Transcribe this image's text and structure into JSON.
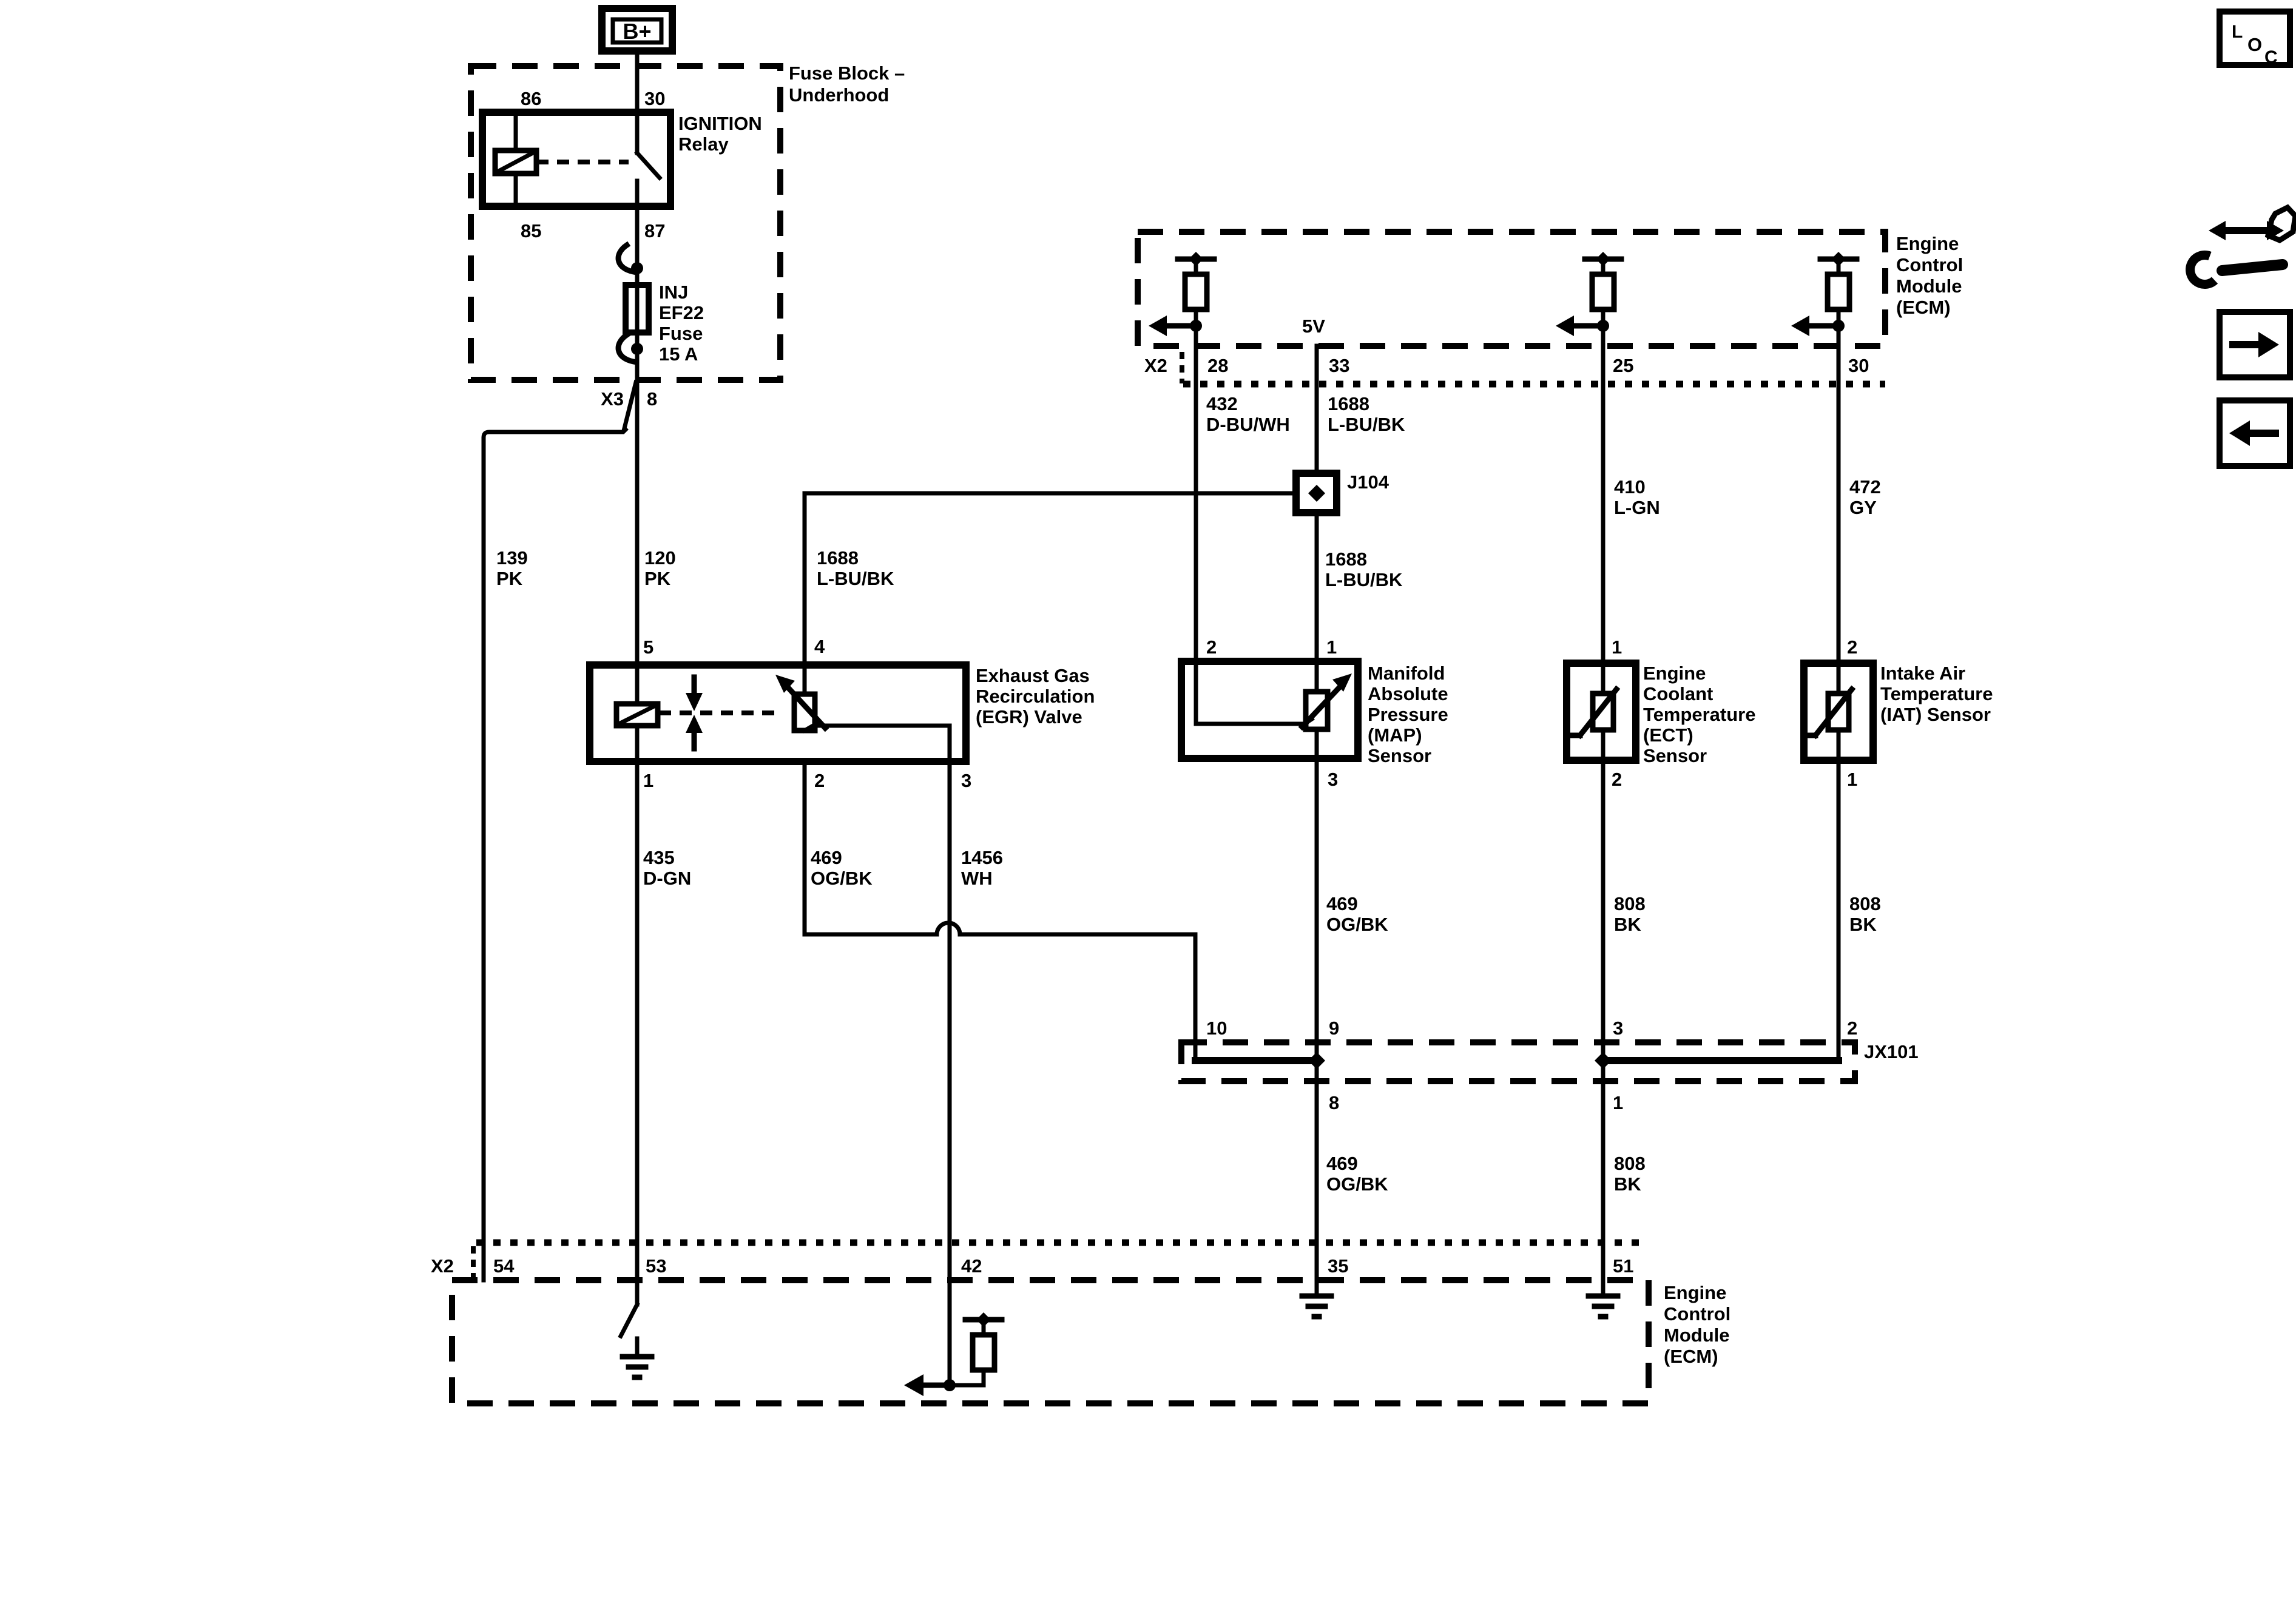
{
  "fuse_block": {
    "label_line1": "Fuse Block –",
    "label_line2": "Underhood",
    "battery": "B+",
    "relay": {
      "name_line1": "IGNITION",
      "name_line2": "Relay",
      "pin_86": "86",
      "pin_30": "30",
      "pin_85": "85",
      "pin_87": "87"
    },
    "fuse": {
      "line1": "INJ",
      "line2": "EF22",
      "line3": "Fuse",
      "line4": "15 A"
    },
    "connector": {
      "name": "X3",
      "pin": "8"
    }
  },
  "ecm_top": {
    "connector": "X2",
    "supply": "5V",
    "pin_28": "28",
    "pin_33": "33",
    "pin_25": "25",
    "pin_30": "30",
    "name_line1": "Engine",
    "name_line2": "Control",
    "name_line3": "Module",
    "name_line4": "(ECM)"
  },
  "ecm_bottom": {
    "connector": "X2",
    "pin_54": "54",
    "pin_53": "53",
    "pin_42": "42",
    "pin_35": "35",
    "pin_51": "51",
    "name_line1": "Engine",
    "name_line2": "Control",
    "name_line3": "Module",
    "name_line4": "(ECM)"
  },
  "egr_valve": {
    "name_line1": "Exhaust Gas",
    "name_line2": "Recirculation",
    "name_line3": "(EGR) Valve",
    "pin_5": "5",
    "pin_4": "4",
    "pin_1": "1",
    "pin_2": "2",
    "pin_3": "3"
  },
  "map_sensor": {
    "name_line1": "Manifold",
    "name_line2": "Absolute",
    "name_line3": "Pressure",
    "name_line4": "(MAP)",
    "name_line5": "Sensor",
    "pin_2": "2",
    "pin_1": "1",
    "pin_3": "3"
  },
  "ect_sensor": {
    "name_line1": "Engine",
    "name_line2": "Coolant",
    "name_line3": "Temperature",
    "name_line4": "(ECT)",
    "name_line5": "Sensor",
    "pin_1": "1",
    "pin_2": "2"
  },
  "iat_sensor": {
    "name_line1": "Intake Air",
    "name_line2": "Temperature",
    "name_line3": "(IAT) Sensor",
    "pin_2": "2",
    "pin_1": "1"
  },
  "junctions": {
    "j104": "J104",
    "jx101": {
      "name": "JX101",
      "pin_10": "10",
      "pin_9": "9",
      "pin_3": "3",
      "pin_2": "2",
      "pin_8": "8",
      "pin_1": "1"
    }
  },
  "wires": {
    "w139": {
      "code": "139",
      "color": "PK"
    },
    "w120": {
      "code": "120",
      "color": "PK"
    },
    "w1688_egr": {
      "code": "1688",
      "color": "L-BU/BK"
    },
    "w432": {
      "code": "432",
      "color": "D-BU/WH"
    },
    "w1688_ecm": {
      "code": "1688",
      "color": "L-BU/BK"
    },
    "w1688_map": {
      "code": "1688",
      "color": "L-BU/BK"
    },
    "w410": {
      "code": "410",
      "color": "L-GN"
    },
    "w472": {
      "code": "472",
      "color": "GY"
    },
    "w435": {
      "code": "435",
      "color": "D-GN"
    },
    "w469_egr": {
      "code": "469",
      "color": "OG/BK"
    },
    "w1456": {
      "code": "1456",
      "color": "WH"
    },
    "w469_map": {
      "code": "469",
      "color": "OG/BK"
    },
    "w808_ect": {
      "code": "808",
      "color": "BK"
    },
    "w808_iat": {
      "code": "808",
      "color": "BK"
    },
    "w469_ecm": {
      "code": "469",
      "color": "OG/BK"
    },
    "w808_ecm": {
      "code": "808",
      "color": "BK"
    }
  },
  "toolbar": {
    "loc_l": "L",
    "loc_o": "O",
    "loc_c": "C"
  },
  "colors": {
    "ink": "#000000",
    "paper": "#ffffff"
  }
}
